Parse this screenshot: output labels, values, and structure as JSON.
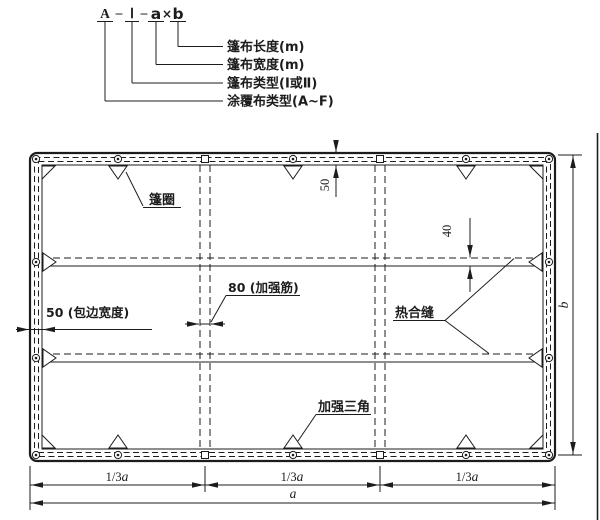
{
  "designation": {
    "code": {
      "fabric_type": "A",
      "sep1": "–",
      "tarp_type": "Ⅰ",
      "sep2": "–",
      "width_var": "a",
      "times": "×",
      "length_var": "b"
    },
    "labels": {
      "length": "篷布长度(m)",
      "width": "篷布宽度(m)",
      "type": "篷布类型(Ⅰ或Ⅱ)",
      "coated": "涂覆布类型(A~F)"
    }
  },
  "drawing": {
    "callouts": {
      "grommet": "篷圈",
      "rib": "80 (加强筋)",
      "binding": "50 (包边宽度)",
      "heat_seam": "热合缝",
      "triangle": "加强三角"
    },
    "dims": {
      "top_edge": "50",
      "seam_overlap": "40",
      "thirds": [
        {
          "frac": "1/3",
          "var": "a"
        },
        {
          "frac": "1/3",
          "var": "a"
        },
        {
          "frac": "1/3",
          "var": "a"
        }
      ],
      "width": "a",
      "height": "b"
    }
  },
  "colors": {
    "ink": "#1c1c1c",
    "background": "#ffffff"
  }
}
